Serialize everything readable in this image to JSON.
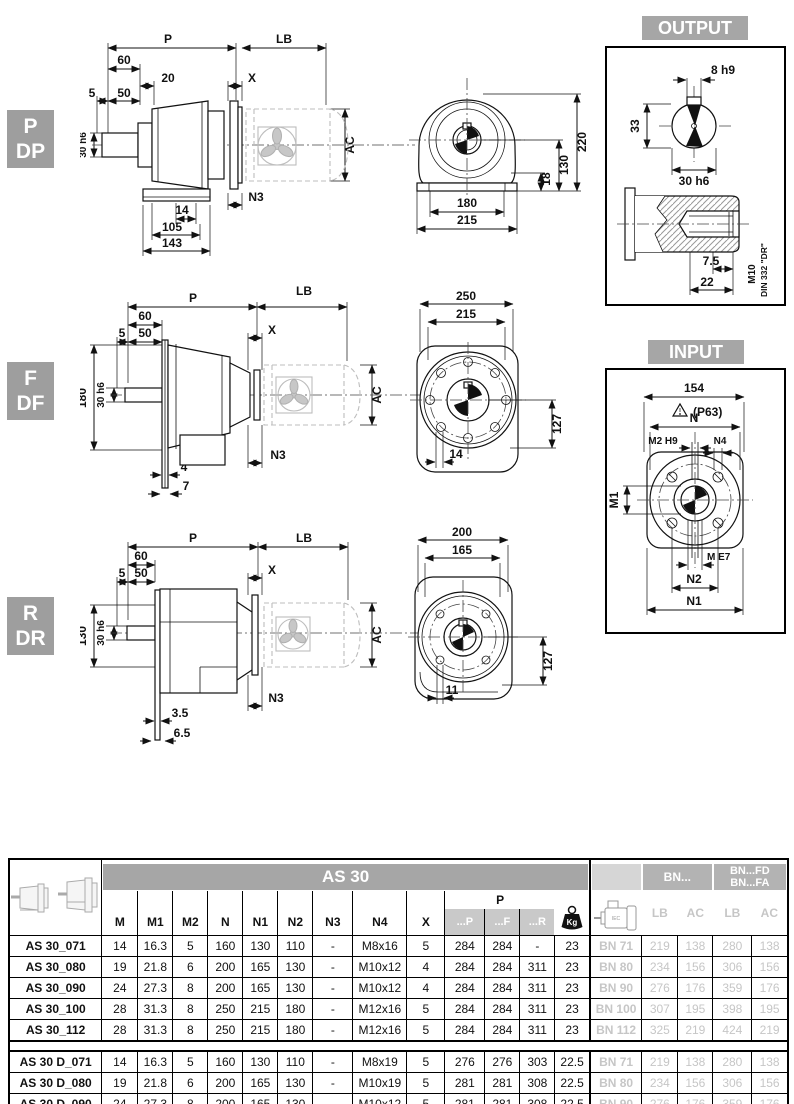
{
  "variants": {
    "pdp": {
      "badge_top": "P",
      "badge_bottom": "DP"
    },
    "fdf": {
      "badge_top": "F",
      "badge_bottom": "DF"
    },
    "rdr": {
      "badge_top": "R",
      "badge_bottom": "DR"
    }
  },
  "side_pdp": {
    "p": "P",
    "lb": "LB",
    "d60": "60",
    "d20": "20",
    "d5": "5",
    "d50": "50",
    "shaft": "30 h6",
    "x": "X",
    "ac": "AC",
    "n3": "N3",
    "d14": "14",
    "d105": "105",
    "d143": "143"
  },
  "front_pdp": {
    "d220": "220",
    "d130": "130",
    "d18": "18",
    "d180": "180",
    "d215": "215"
  },
  "side_fdf": {
    "p": "P",
    "lb": "LB",
    "d60": "60",
    "d5": "5",
    "d50": "50",
    "shaft": "30 h6",
    "d180": "180",
    "x": "X",
    "ac": "AC",
    "n3": "N3",
    "d4": "4",
    "d7": "7"
  },
  "front_fdf": {
    "d250": "250",
    "d215": "215",
    "d127": "127",
    "d14": "14"
  },
  "side_rdr": {
    "p": "P",
    "lb": "LB",
    "d60": "60",
    "d5": "5",
    "d50": "50",
    "shaft": "30 h6",
    "d130": "130",
    "x": "X",
    "ac": "AC",
    "n3": "N3",
    "d35": "3.5",
    "d65": "6.5"
  },
  "front_rdr": {
    "d200": "200",
    "d165": "165",
    "d127": "127",
    "d11": "11"
  },
  "output_panel": {
    "title": "OUTPUT",
    "key": "8 h9",
    "d33": "33",
    "shaft": "30 h6",
    "d75": "7.5",
    "d22": "22",
    "thread": "M10",
    "din": "DIN 332 \"DR\""
  },
  "input_panel": {
    "title": "INPUT",
    "d154": "154",
    "p63": "(P63)",
    "n": "N",
    "m2": "M2 H9",
    "n4": "N4",
    "m1": "M1",
    "me7": "M E7",
    "n2": "N2",
    "n1": "N1"
  },
  "table": {
    "title": "AS 30",
    "col_headers": [
      "M",
      "M1",
      "M2",
      "N",
      "N1",
      "N2",
      "N3",
      "N4",
      "X"
    ],
    "p_label": "P",
    "p_subs": [
      "...P",
      "...F",
      "...R"
    ],
    "kg_label": "Kg",
    "bn_label": "BN...",
    "bnfd_line1": "BN...FD",
    "bnfd_line2": "BN...FA",
    "lbac": [
      "LB",
      "AC",
      "LB",
      "AC"
    ],
    "rows": [
      {
        "name": "AS 30_071",
        "dims": [
          "14",
          "16.3",
          "5",
          "160",
          "130",
          "110",
          "-",
          "M8x16",
          "5"
        ],
        "p": [
          "284",
          "284",
          "-"
        ],
        "kg": "23",
        "bn": "BN 71",
        "bn_dims": [
          "219",
          "138",
          "280",
          "138"
        ]
      },
      {
        "name": "AS 30_080",
        "dims": [
          "19",
          "21.8",
          "6",
          "200",
          "165",
          "130",
          "-",
          "M10x12",
          "4"
        ],
        "p": [
          "284",
          "284",
          "311"
        ],
        "kg": "23",
        "bn": "BN 80",
        "bn_dims": [
          "234",
          "156",
          "306",
          "156"
        ]
      },
      {
        "name": "AS 30_090",
        "dims": [
          "24",
          "27.3",
          "8",
          "200",
          "165",
          "130",
          "-",
          "M10x12",
          "4"
        ],
        "p": [
          "284",
          "284",
          "311"
        ],
        "kg": "23",
        "bn": "BN 90",
        "bn_dims": [
          "276",
          "176",
          "359",
          "176"
        ]
      },
      {
        "name": "AS 30_100",
        "dims": [
          "28",
          "31.3",
          "8",
          "250",
          "215",
          "180",
          "-",
          "M12x16",
          "5"
        ],
        "p": [
          "284",
          "284",
          "311"
        ],
        "kg": "23",
        "bn": "BN 100",
        "bn_dims": [
          "307",
          "195",
          "398",
          "195"
        ]
      },
      {
        "name": "AS 30_112",
        "dims": [
          "28",
          "31.3",
          "8",
          "250",
          "215",
          "180",
          "-",
          "M12x16",
          "5"
        ],
        "p": [
          "284",
          "284",
          "311"
        ],
        "kg": "23",
        "bn": "BN 112",
        "bn_dims": [
          "325",
          "219",
          "424",
          "219"
        ]
      }
    ],
    "rows_d": [
      {
        "name": "AS 30 D_071",
        "dims": [
          "14",
          "16.3",
          "5",
          "160",
          "130",
          "110",
          "-",
          "M8x19",
          "5"
        ],
        "p": [
          "276",
          "276",
          "303"
        ],
        "kg": "22.5",
        "bn": "BN 71",
        "bn_dims": [
          "219",
          "138",
          "280",
          "138"
        ]
      },
      {
        "name": "AS 30 D_080",
        "dims": [
          "19",
          "21.8",
          "6",
          "200",
          "165",
          "130",
          "-",
          "M10x19",
          "5"
        ],
        "p": [
          "281",
          "281",
          "308"
        ],
        "kg": "22.5",
        "bn": "BN 80",
        "bn_dims": [
          "234",
          "156",
          "306",
          "156"
        ]
      },
      {
        "name": "AS 30 D_090",
        "dims": [
          "24",
          "27.3",
          "8",
          "200",
          "165",
          "130",
          "-",
          "M10x12",
          "5"
        ],
        "p": [
          "281",
          "281",
          "308"
        ],
        "kg": "22.5",
        "bn": "BN 90",
        "bn_dims": [
          "276",
          "176",
          "359",
          "176"
        ]
      }
    ]
  }
}
